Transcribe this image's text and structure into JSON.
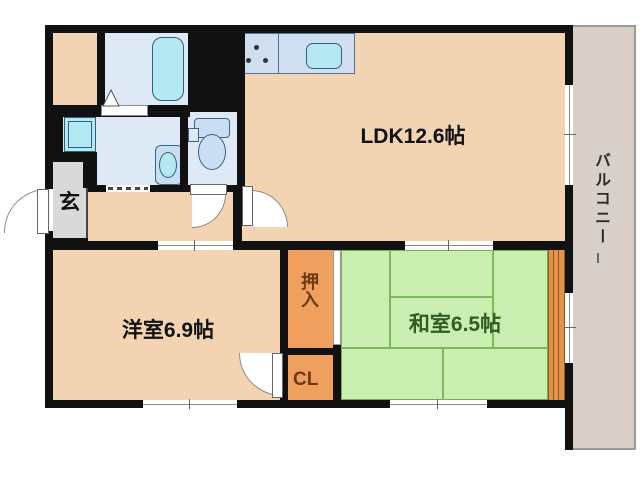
{
  "floorplan": {
    "type": "apartment-floor-plan",
    "rooms": {
      "ldk": {
        "label": "LDK12.6帖",
        "color": "#f2d4b2"
      },
      "western_room": {
        "label": "洋室6.9帖",
        "color": "#f2d4b2"
      },
      "japanese_room": {
        "label": "和室6.5帖",
        "color": "#c9eeb0"
      },
      "oshiire": {
        "label": "押入",
        "color": "#f0a05e"
      },
      "cl_closet": {
        "label": "CL",
        "color": "#f0a05e"
      },
      "entrance": {
        "label": "玄",
        "color": "#d9d9d9"
      },
      "balcony": {
        "label": "バルコニー",
        "color": "#d8cfc9"
      }
    },
    "colors": {
      "wall": "#111111",
      "wet_area_blue": "#dde9f5",
      "fixture_cyan": "#b5e9f2",
      "counter_blue": "#cfdfef",
      "tatami_green": "#c9eeb0",
      "tatami_line_green": "#7cb85c",
      "wood_edge_orange": "#e3924d",
      "balcony_gray": "#d8cfc9",
      "entrance_gray": "#d9d9d9"
    }
  }
}
